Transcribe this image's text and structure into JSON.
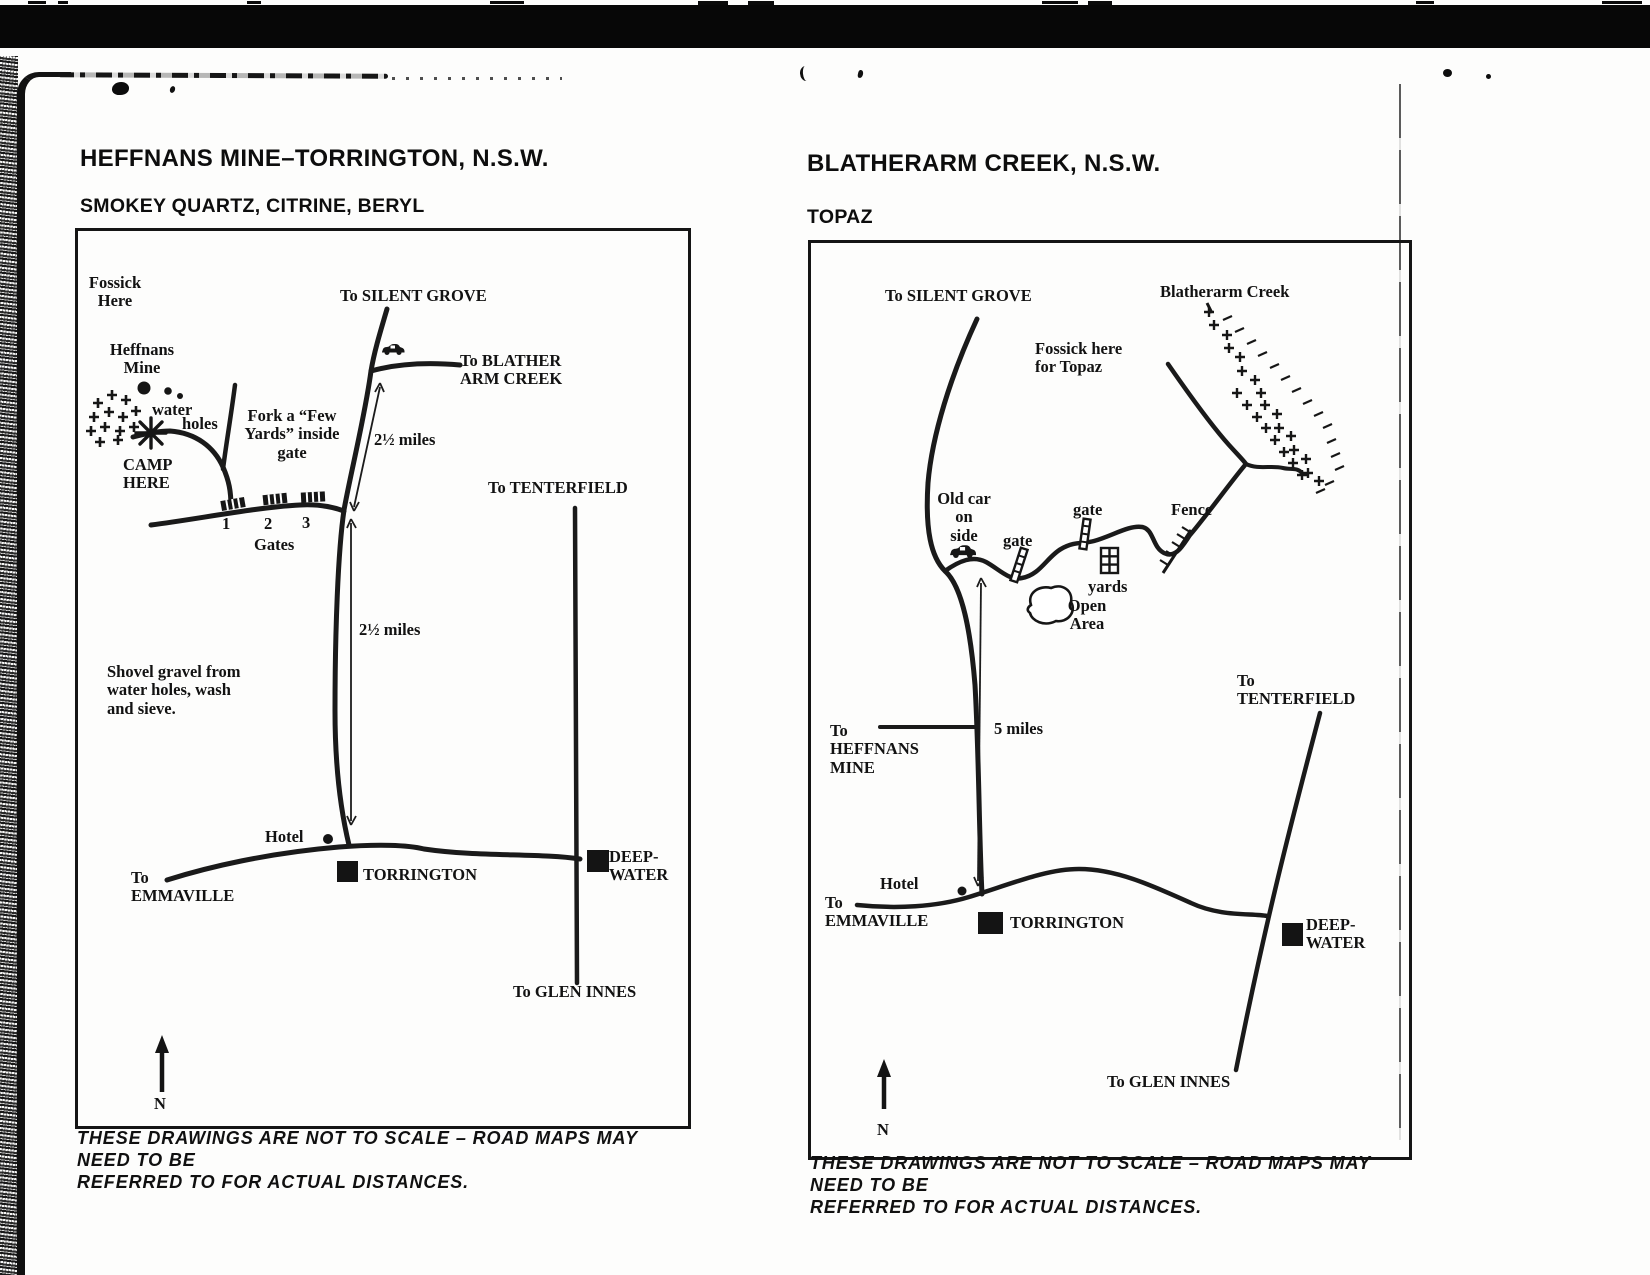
{
  "left_map": {
    "title": "HEFFNANS MINE–TORRINGTON, N.S.W.",
    "subtitle": "SMOKEY QUARTZ, CITRINE, BERYL",
    "labels": {
      "fossick_here": "Fossick\nHere",
      "to_silent_grove": "To SILENT GROVE",
      "heffnans_mine": "Heffnans\nMine",
      "water": "water",
      "holes": "holes",
      "camp_here": "CAMP\nHERE",
      "fork_note": "Fork a “Few\nYards” inside\ngate",
      "to_blather_arm_creek": "To BLATHER\nARM CREEK",
      "miles_upper": "2½ miles",
      "miles_lower": "2½ miles",
      "gate_numbers": [
        "1",
        "2",
        "3"
      ],
      "gates": "Gates",
      "to_tenterfield": "To TENTERFIELD",
      "shovel_note": "Shovel gravel from\nwater holes, wash\nand sieve.",
      "hotel": "Hotel",
      "torrington": "TORRINGTON",
      "to_emmaville": "To\nEMMAVILLE",
      "deep_water": "DEEP-\nWATER",
      "to_glen_innes": "To GLEN INNES",
      "north": "N"
    },
    "footnote": "THESE DRAWINGS ARE NOT TO SCALE – ROAD MAPS MAY NEED TO BE\nREFERRED TO FOR ACTUAL DISTANCES."
  },
  "right_map": {
    "title": "BLATHERARM CREEK, N.S.W.",
    "subtitle": "TOPAZ",
    "labels": {
      "to_silent_grove": "To SILENT GROVE",
      "blatherarm_creek": "Blatherarm Creek",
      "fossick_topaz": "Fossick here\nfor Topaz",
      "old_car": "Old car\non\nside",
      "gate_1": "gate",
      "gate_2": "gate",
      "fence": "Fence",
      "yards": "yards",
      "open_area": "Open\nArea",
      "to_heffnans_mine": "To\nHEFFNANS\nMINE",
      "five_miles": "5 miles",
      "to_tenterfield": "To\nTENTERFIELD",
      "hotel": "Hotel",
      "to_emmaville": "To\nEMMAVILLE",
      "torrington": "TORRINGTON",
      "deep_water": "DEEP-\nWATER",
      "to_glen_innes": "To GLEN INNES",
      "north": "N"
    },
    "footnote": "THESE DRAWINGS ARE NOT TO SCALE – ROAD MAPS MAY NEED TO BE\nREFERRED TO FOR ACTUAL DISTANCES."
  }
}
